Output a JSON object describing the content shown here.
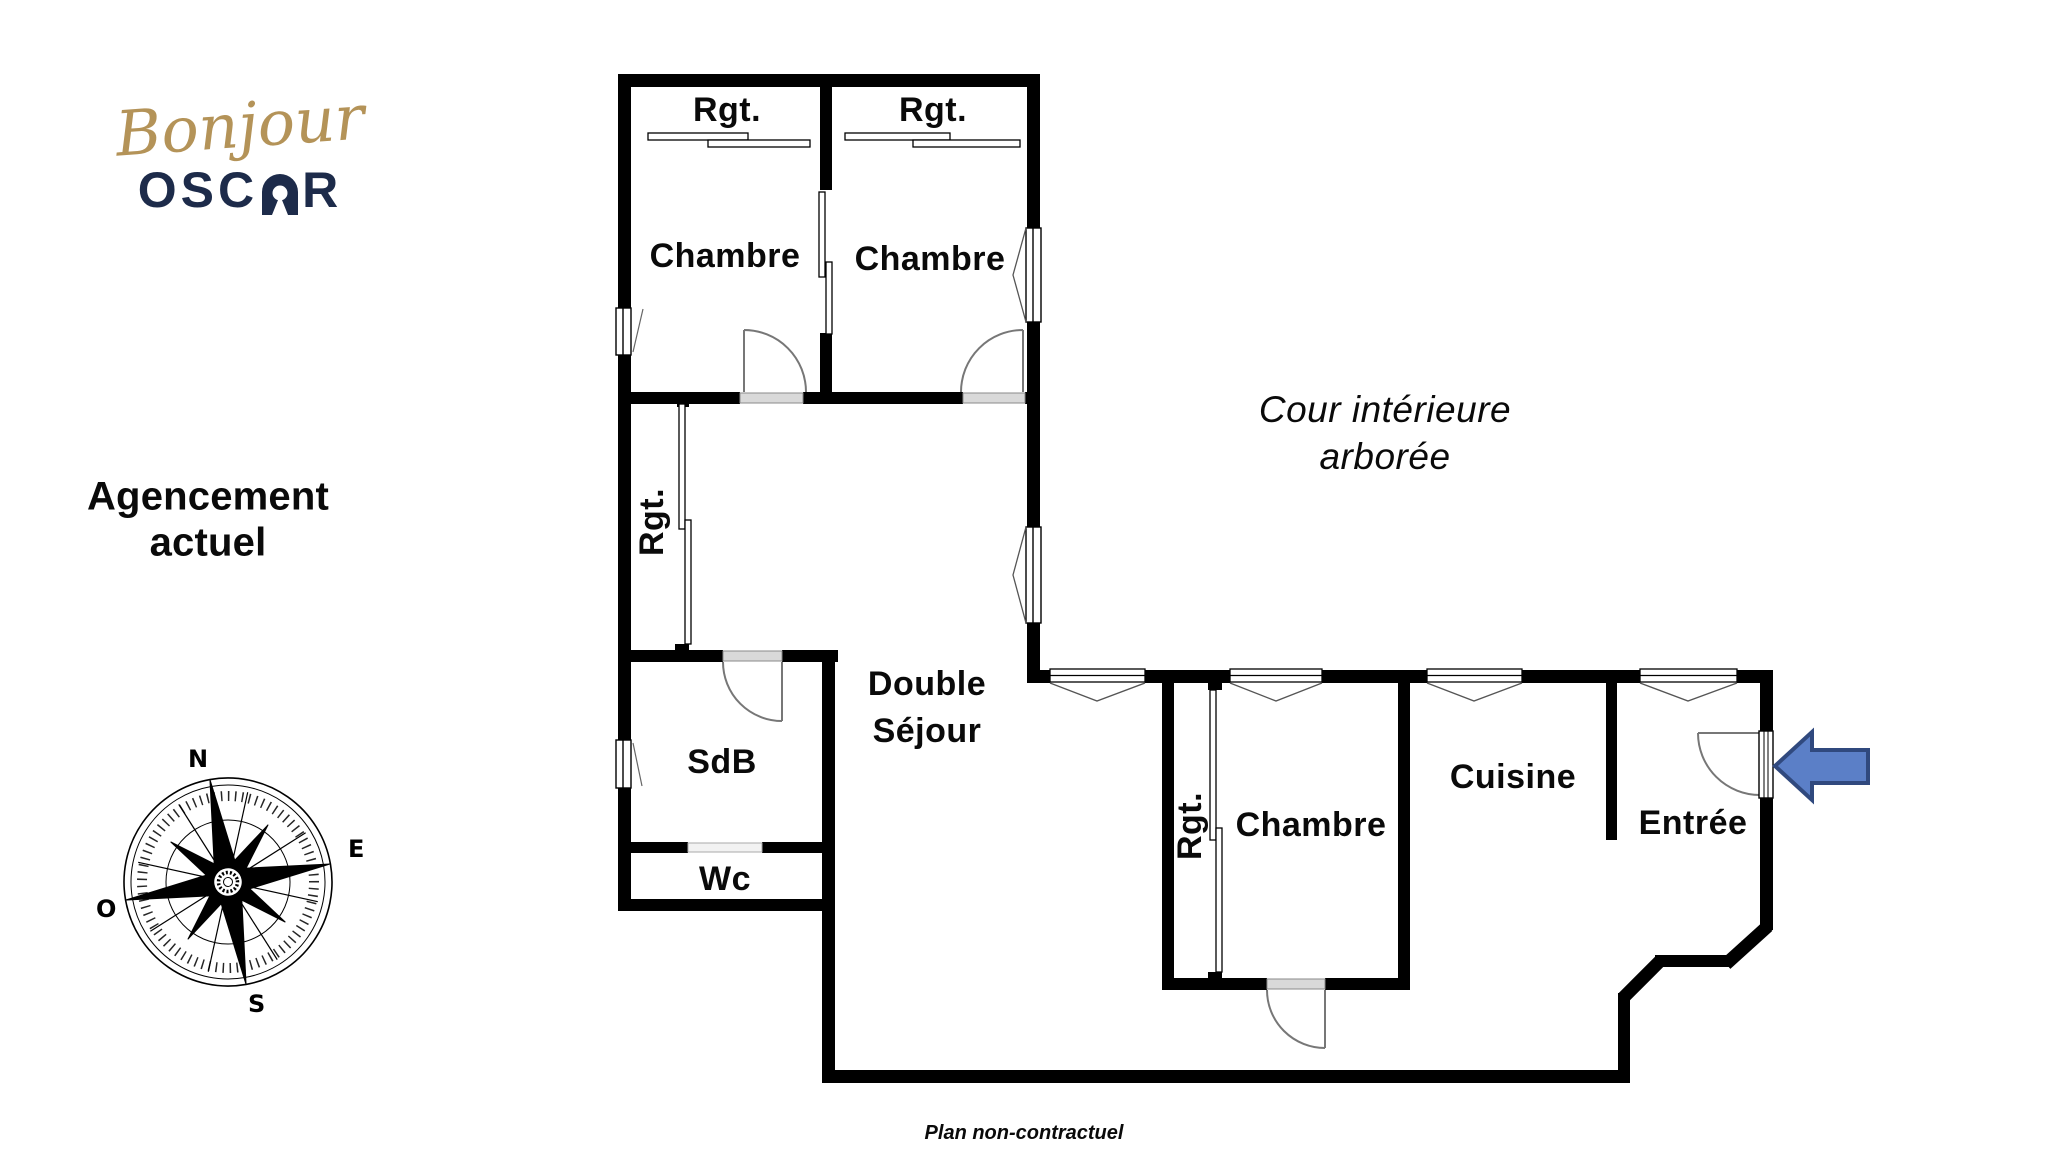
{
  "logo": {
    "script_word": "Bonjour",
    "brand_prefix": "OSC",
    "brand_suffix": "R",
    "script_color": "#b49358",
    "brand_color": "#1d2b4a"
  },
  "left_panel": {
    "title_line1": "Agencement",
    "title_line2": "actuel",
    "compass": {
      "north": "N",
      "east": "E",
      "south": "S",
      "west": "O"
    }
  },
  "floorplan": {
    "wall_color": "#000000",
    "door_arc_color": "#777777",
    "arrow_fill": "#5b7fc7",
    "arrow_border": "#30497e",
    "rooms": {
      "rgt_top_left": "Rgt.",
      "rgt_top_right": "Rgt.",
      "chambre_top_left": "Chambre",
      "chambre_top_right": "Chambre",
      "rgt_corridor": "Rgt.",
      "double_sejour_line1": "Double",
      "double_sejour_line2": "Séjour",
      "sdb": "SdB",
      "wc": "Wc",
      "rgt_bottom": "Rgt.",
      "chambre_bottom": "Chambre",
      "cuisine": "Cuisine",
      "entree": "Entrée"
    },
    "courtyard_line1": "Cour intérieure",
    "courtyard_line2": "arborée"
  },
  "footer": {
    "note": "Plan non-contractuel"
  }
}
